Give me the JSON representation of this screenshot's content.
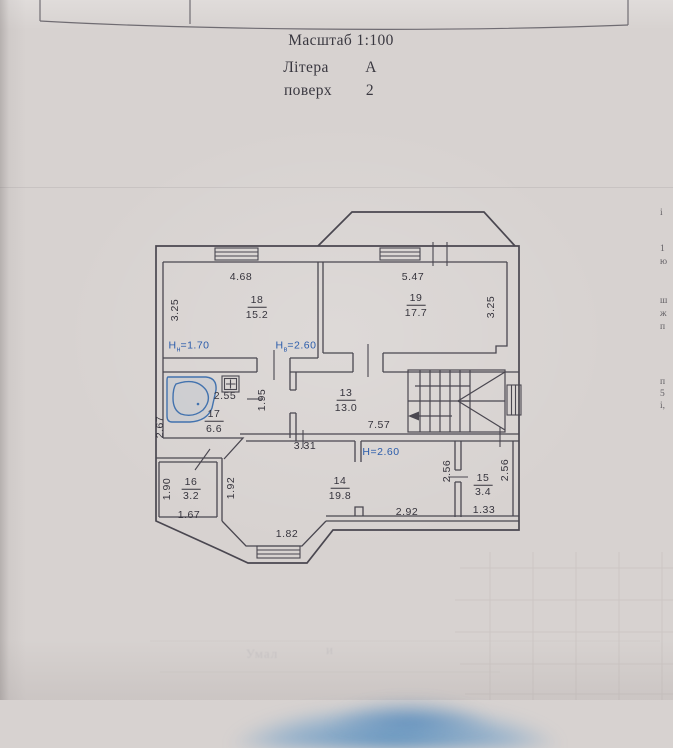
{
  "header": {
    "scale": "Масштаб 1:100",
    "litera_label": "Літера",
    "litera_value": "А",
    "floor_label": "поверх",
    "floor_value": "2"
  },
  "plan": {
    "colors": {
      "ink": "#36343d",
      "blue": "#2b5cab",
      "tub": "#4272ae"
    },
    "rooms": [
      {
        "number": "18",
        "area": "15.2",
        "h_low": "Hн=1.70",
        "h_high": "Hв=2.60"
      },
      {
        "number": "19",
        "area": "17.7"
      },
      {
        "number": "17",
        "area": "6.6"
      },
      {
        "number": "13",
        "area": "13.0"
      },
      {
        "number": "16",
        "area": "3.2"
      },
      {
        "number": "14",
        "area": "19.8",
        "height": "H=2.60"
      },
      {
        "number": "15",
        "area": "3.4"
      }
    ],
    "labels": [
      {
        "t": "4.68",
        "x": 241,
        "y": 277,
        "k": "dim"
      },
      {
        "t": "3.25",
        "x": 175,
        "y": 310,
        "r": 1,
        "k": "dim"
      },
      {
        "t": "18",
        "x": 257,
        "y": 301,
        "u": 1,
        "k": "room"
      },
      {
        "t": "15.2",
        "x": 257,
        "y": 315,
        "k": "area"
      },
      {
        "pre": "H",
        "sub": "н",
        "post": "=1.70",
        "x": 189,
        "y": 347,
        "c": "blue",
        "k": "height"
      },
      {
        "pre": "H",
        "sub": "в",
        "post": "=2.60",
        "x": 296,
        "y": 347,
        "c": "blue",
        "k": "height"
      },
      {
        "t": "5.47",
        "x": 413,
        "y": 277,
        "k": "dim"
      },
      {
        "t": "19",
        "x": 416,
        "y": 299,
        "u": 1,
        "k": "room"
      },
      {
        "t": "17.7",
        "x": 416,
        "y": 313,
        "k": "area"
      },
      {
        "t": "3.25",
        "x": 491,
        "y": 307,
        "r": 1,
        "k": "dim"
      },
      {
        "t": "2.55",
        "x": 225,
        "y": 396,
        "k": "dim"
      },
      {
        "t": "1.95",
        "x": 262,
        "y": 400,
        "r": 1,
        "k": "dim"
      },
      {
        "t": "17",
        "x": 214,
        "y": 415,
        "u": 1,
        "k": "room"
      },
      {
        "t": "6.6",
        "x": 214,
        "y": 429,
        "k": "area"
      },
      {
        "t": "2.67",
        "x": 160,
        "y": 427,
        "r": 1,
        "k": "dim"
      },
      {
        "t": "13",
        "x": 346,
        "y": 394,
        "u": 1,
        "k": "room"
      },
      {
        "t": "13.0",
        "x": 346,
        "y": 408,
        "k": "area"
      },
      {
        "t": "7.57",
        "x": 379,
        "y": 425,
        "k": "dim"
      },
      {
        "t": "3.31",
        "x": 305,
        "y": 446,
        "k": "dim"
      },
      {
        "t": "H=2.60",
        "x": 381,
        "y": 452,
        "c": "blue",
        "k": "height"
      },
      {
        "t": "1.90",
        "x": 167,
        "y": 489,
        "r": 1,
        "k": "dim"
      },
      {
        "t": "16",
        "x": 191,
        "y": 483,
        "u": 1,
        "k": "room"
      },
      {
        "t": "3.2",
        "x": 191,
        "y": 496,
        "k": "area"
      },
      {
        "t": "1.67",
        "x": 189,
        "y": 515,
        "k": "dim"
      },
      {
        "t": "1.92",
        "x": 231,
        "y": 488,
        "r": 1,
        "k": "dim"
      },
      {
        "t": "14",
        "x": 340,
        "y": 482,
        "u": 1,
        "k": "room"
      },
      {
        "t": "19.8",
        "x": 340,
        "y": 496,
        "k": "area"
      },
      {
        "t": "1.82",
        "x": 287,
        "y": 534,
        "k": "dim"
      },
      {
        "t": "2.92",
        "x": 407,
        "y": 512,
        "k": "dim"
      },
      {
        "t": "2.56",
        "x": 447,
        "y": 471,
        "r": 1,
        "k": "dim"
      },
      {
        "t": "15",
        "x": 483,
        "y": 479,
        "u": 1,
        "k": "room"
      },
      {
        "t": "3.4",
        "x": 483,
        "y": 492,
        "k": "area"
      },
      {
        "t": "2.56",
        "x": 505,
        "y": 470,
        "r": 1,
        "k": "dim"
      },
      {
        "t": "1.33",
        "x": 484,
        "y": 510,
        "k": "dim"
      }
    ]
  },
  "edge_fragments": [
    {
      "t": "і",
      "y": 213
    },
    {
      "t": "1",
      "y": 249
    },
    {
      "t": "ю",
      "y": 262
    },
    {
      "t": "ш",
      "y": 301
    },
    {
      "t": "ж",
      "y": 314
    },
    {
      "t": "п",
      "y": 327
    },
    {
      "t": "п",
      "y": 382
    },
    {
      "t": "5",
      "y": 394
    },
    {
      "t": "і,",
      "y": 406
    }
  ],
  "watermarks": [
    {
      "t": "Умал",
      "x": 262,
      "y": 654
    },
    {
      "t": "и",
      "x": 330,
      "y": 650
    }
  ]
}
